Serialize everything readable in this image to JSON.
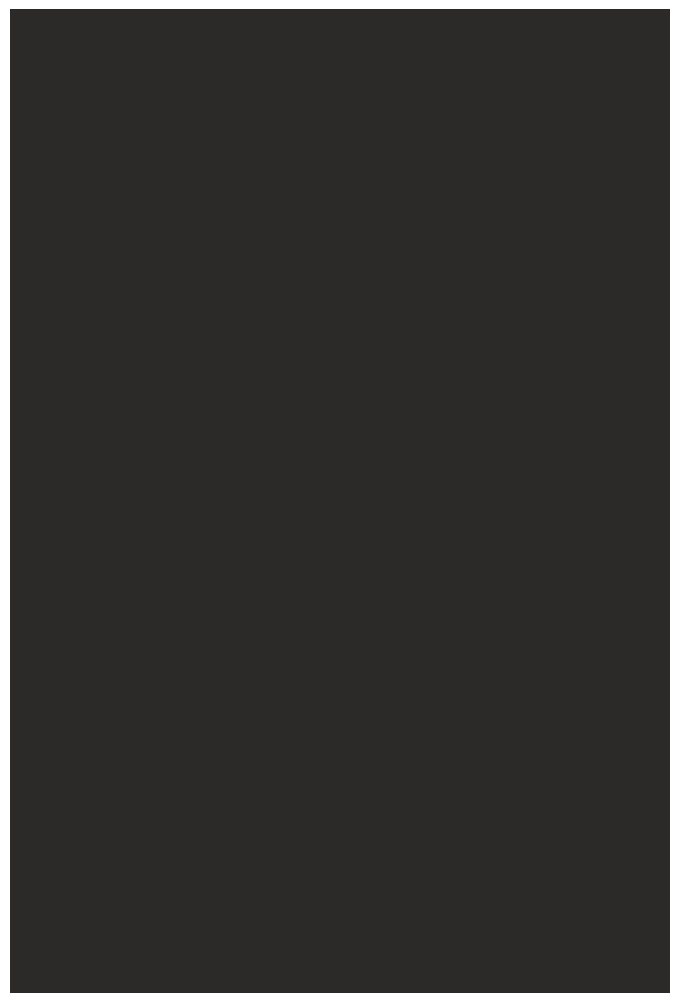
{
  "screen": {
    "description": "blank dark screen with no visible content",
    "background_color": "#2b2a28",
    "left_margin_px": 10,
    "top_margin_px": 9,
    "right_margin_px": 4,
    "bottom_margin_px": 7
  },
  "page": {
    "background_color": "#ffffff"
  }
}
